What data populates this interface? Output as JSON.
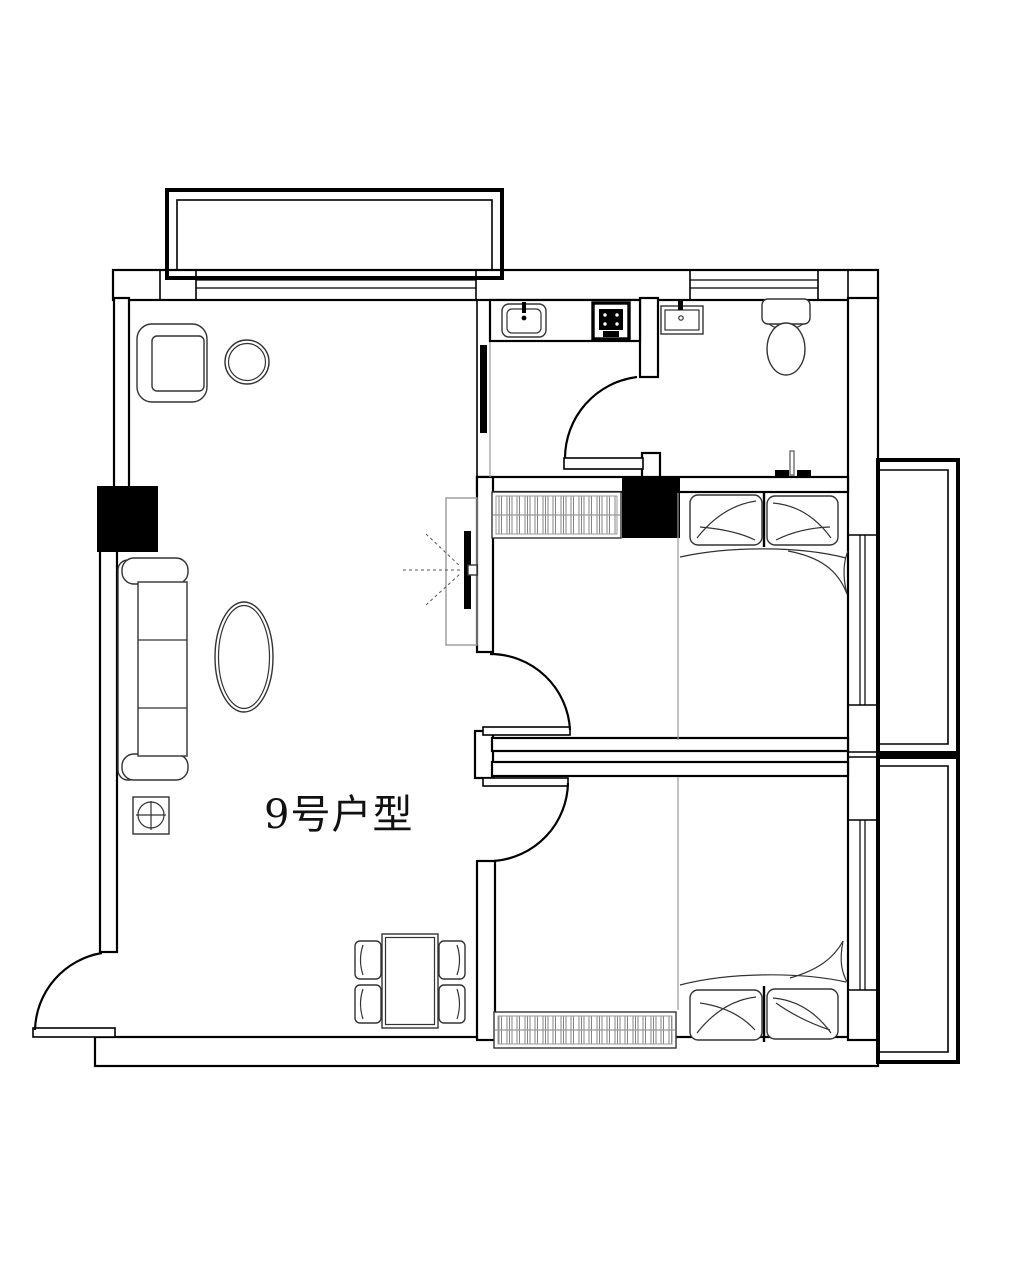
{
  "plan": {
    "title": "9号户型",
    "colors": {
      "line": "#000000",
      "furniture": "#333333",
      "soft": "#9a9a9a",
      "background": "#ffffff"
    }
  }
}
